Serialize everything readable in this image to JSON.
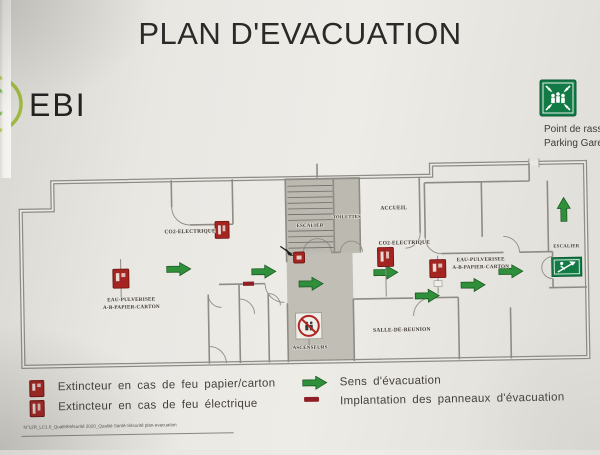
{
  "title": "PLAN D'EVACUATION",
  "logo": {
    "text": "EBI"
  },
  "assembly_point": {
    "line1": "Point de rass",
    "line2": "Parking Gare"
  },
  "plan": {
    "rooms": {
      "escalier_center": "ESCALIER",
      "toilettes": "TOILETTES",
      "accueil": "ACCUEIL",
      "co2_electrique_left": "CO2-ELECTRIQUE",
      "co2_electrique_right": "CO2-ELECTRIQUE",
      "eau_pulverisee_left_line1": "EAU-PULVERISEE",
      "eau_pulverisee_left_line2": "A-B-PAPIER-CARTON",
      "eau_pulverisee_right_line1": "EAU-PULVERISEE",
      "eau_pulverisee_right_line2": "A-B-PAPIER-CARTON",
      "salle_de_reunion": "SALLE-DE-REUNION",
      "ascenseurs": "ASCENSEURS",
      "escalier_right": "ESCALIER"
    }
  },
  "legend": {
    "items": [
      {
        "icon": "extinguisher-paper-icon",
        "label": "Extincteur en cas de feu papier/carton"
      },
      {
        "icon": "extinguisher-electric-icon",
        "label": "Extincteur en cas de feu électrique"
      },
      {
        "icon": "evacuation-arrow-icon",
        "label": "Sens d'évacuation"
      },
      {
        "icon": "panel-marker-icon",
        "label": "Implantation des panneaux d'évacuation"
      }
    ]
  },
  "footer": {
    "doc_ref": "N°12R_LC1.0_QualitéSécurité 2020_Qualité Santé-Sécurité plan-evacuation"
  },
  "colors": {
    "paper": "#ebe9e4",
    "wall": "#8e8c85",
    "ink": "#2b2a28",
    "label": "#3b352f",
    "green": "#2f8f3a",
    "green_dark": "#14521c",
    "sign_green": "#117a45",
    "red": "#a32421",
    "red_dark": "#6d1210",
    "legend_text": "#45403a",
    "logo_green": "#9db93f"
  }
}
